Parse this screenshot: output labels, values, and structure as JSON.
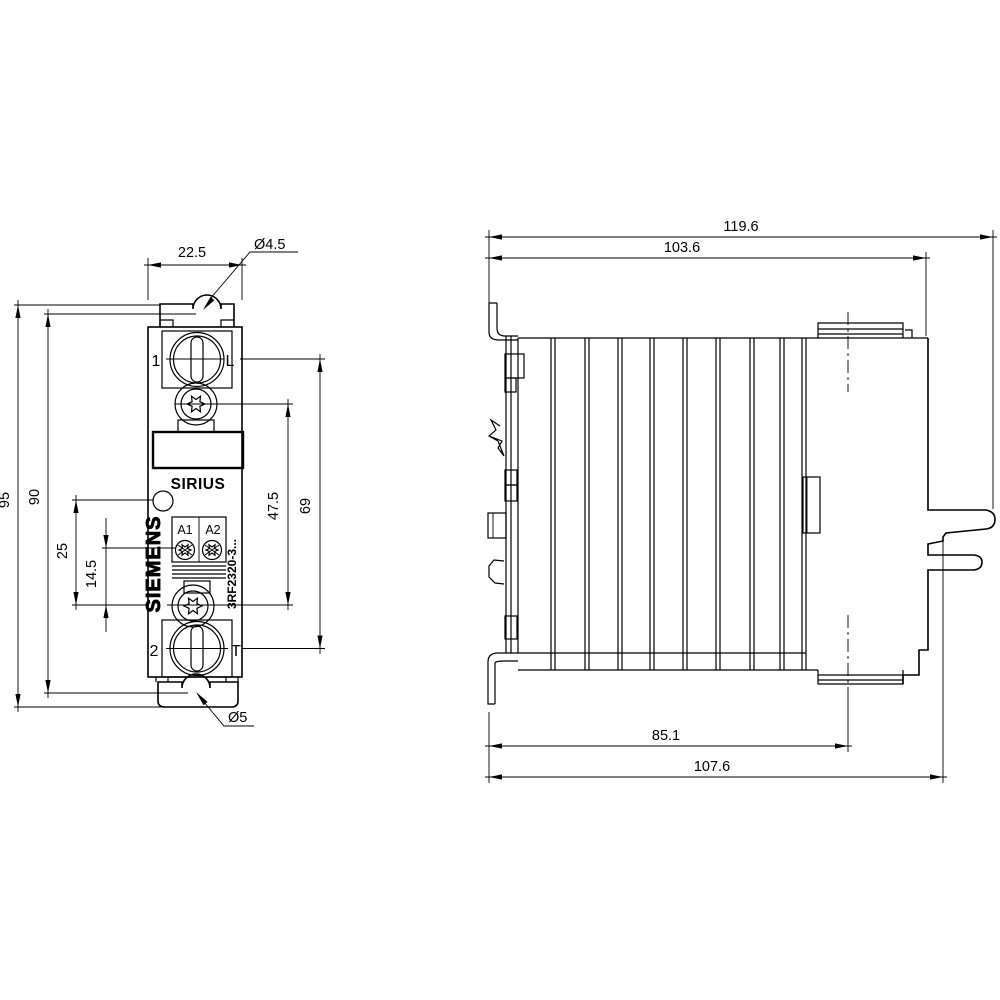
{
  "drawing": {
    "front_view": {
      "labels": {
        "terminal_1": "1",
        "terminal_L": "L",
        "terminal_2": "2",
        "terminal_T": "T",
        "brand": "SIRIUS",
        "manufacturer": "SIEMENS",
        "coil_a1": "A1",
        "coil_a2": "A2",
        "part_number": "3RF2320-3..."
      },
      "dimensions": {
        "width": "22.5",
        "top_slot_dia": "Ø4.5",
        "bottom_slot_dia": "Ø5",
        "overall_height": "95",
        "mounting_pitch": "90",
        "led_to_screw": "25",
        "coil_to_screw": "14.5",
        "screw_pitch": "47.5",
        "terminal_pitch": "69"
      }
    },
    "side_view": {
      "dimensions": {
        "overall_depth": "119.6",
        "body_depth": "103.6",
        "rail_to_center": "85.1",
        "mounting_depth": "107.6"
      }
    }
  }
}
